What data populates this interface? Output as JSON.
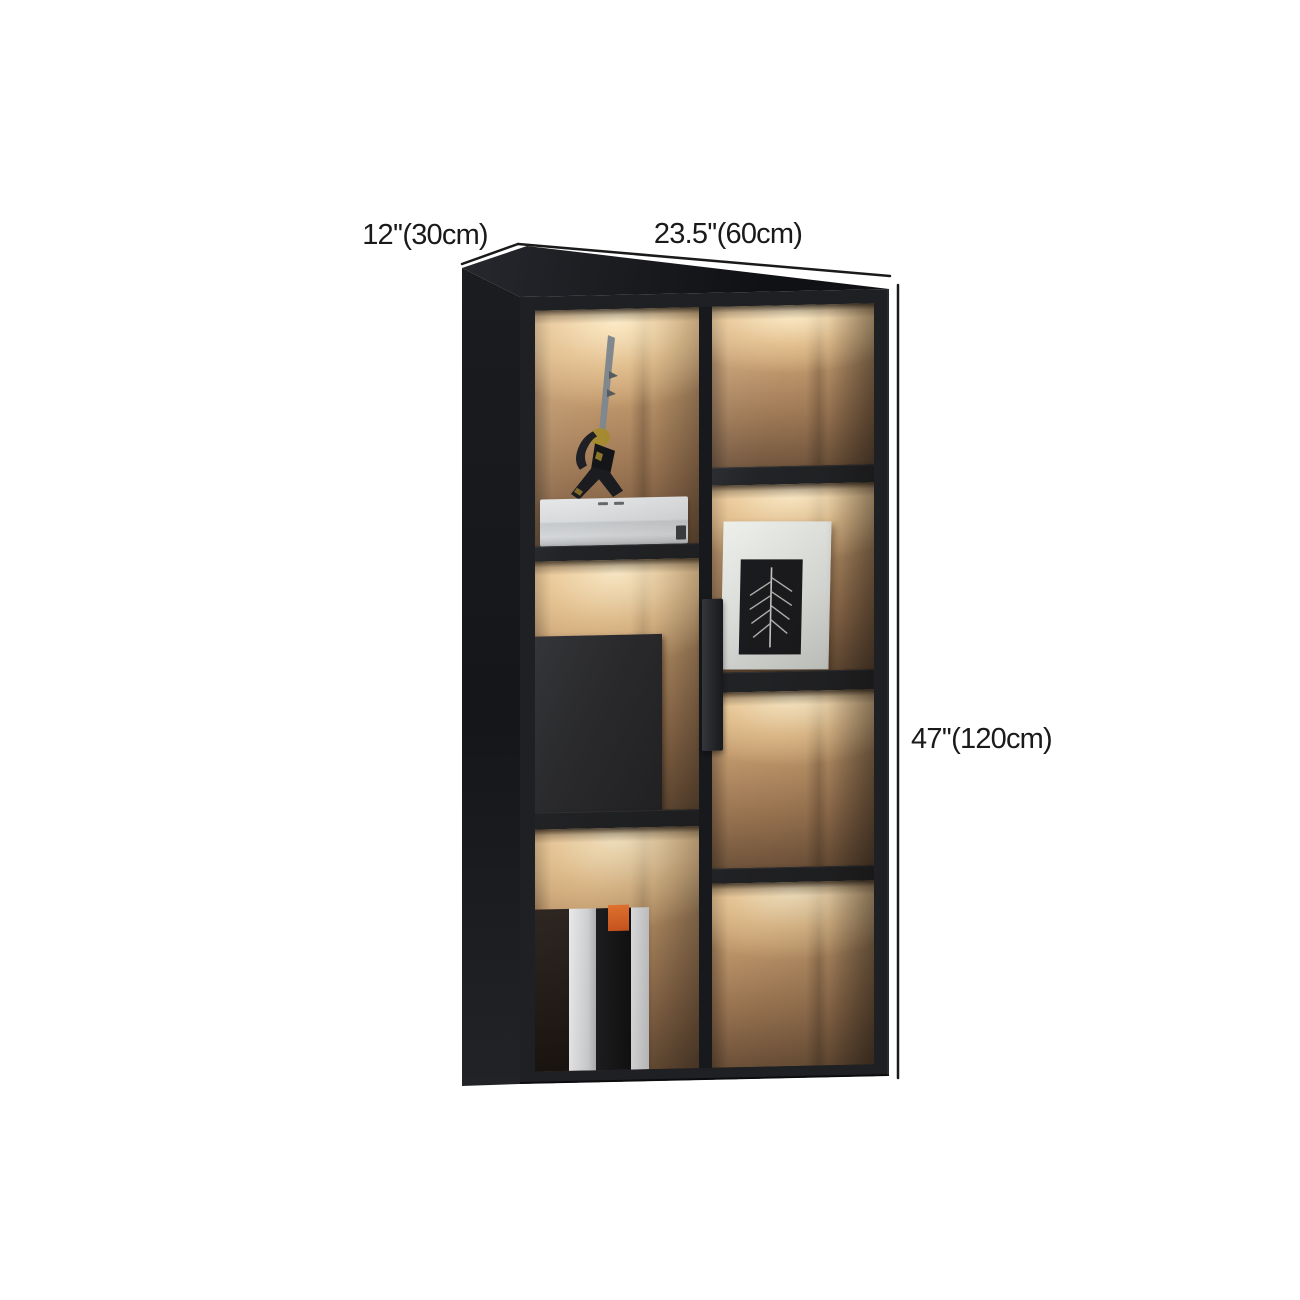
{
  "dimensions": {
    "depth": "12''(30cm)",
    "width": "23.5''(60cm)",
    "height": "47''(120cm)"
  },
  "annotation": {
    "line_color": "#1a1a1a",
    "text_color": "#1a1a1a"
  },
  "product": {
    "description": "Tall black display bookcase with two glass doors, warm interior compartment lighting, samurai figurine, white storage box, closed cabinet section, books and framed leaf artwork",
    "colors": {
      "frame": "#1e2024",
      "side_panel": "#17191c",
      "wood_lit": "#d9b285",
      "wood_shadow": "#6f533a",
      "light_glow": "#ffe6b4",
      "shelf": "#1d1f22",
      "closed_section": "#27282b",
      "white_box": "#d7d9db",
      "picture_frame": "#d9dcd8",
      "book_white": "#eceef0",
      "book_black": "#141518",
      "book_accent": "#e0662a",
      "figurine_gold": "#a3882c"
    }
  }
}
